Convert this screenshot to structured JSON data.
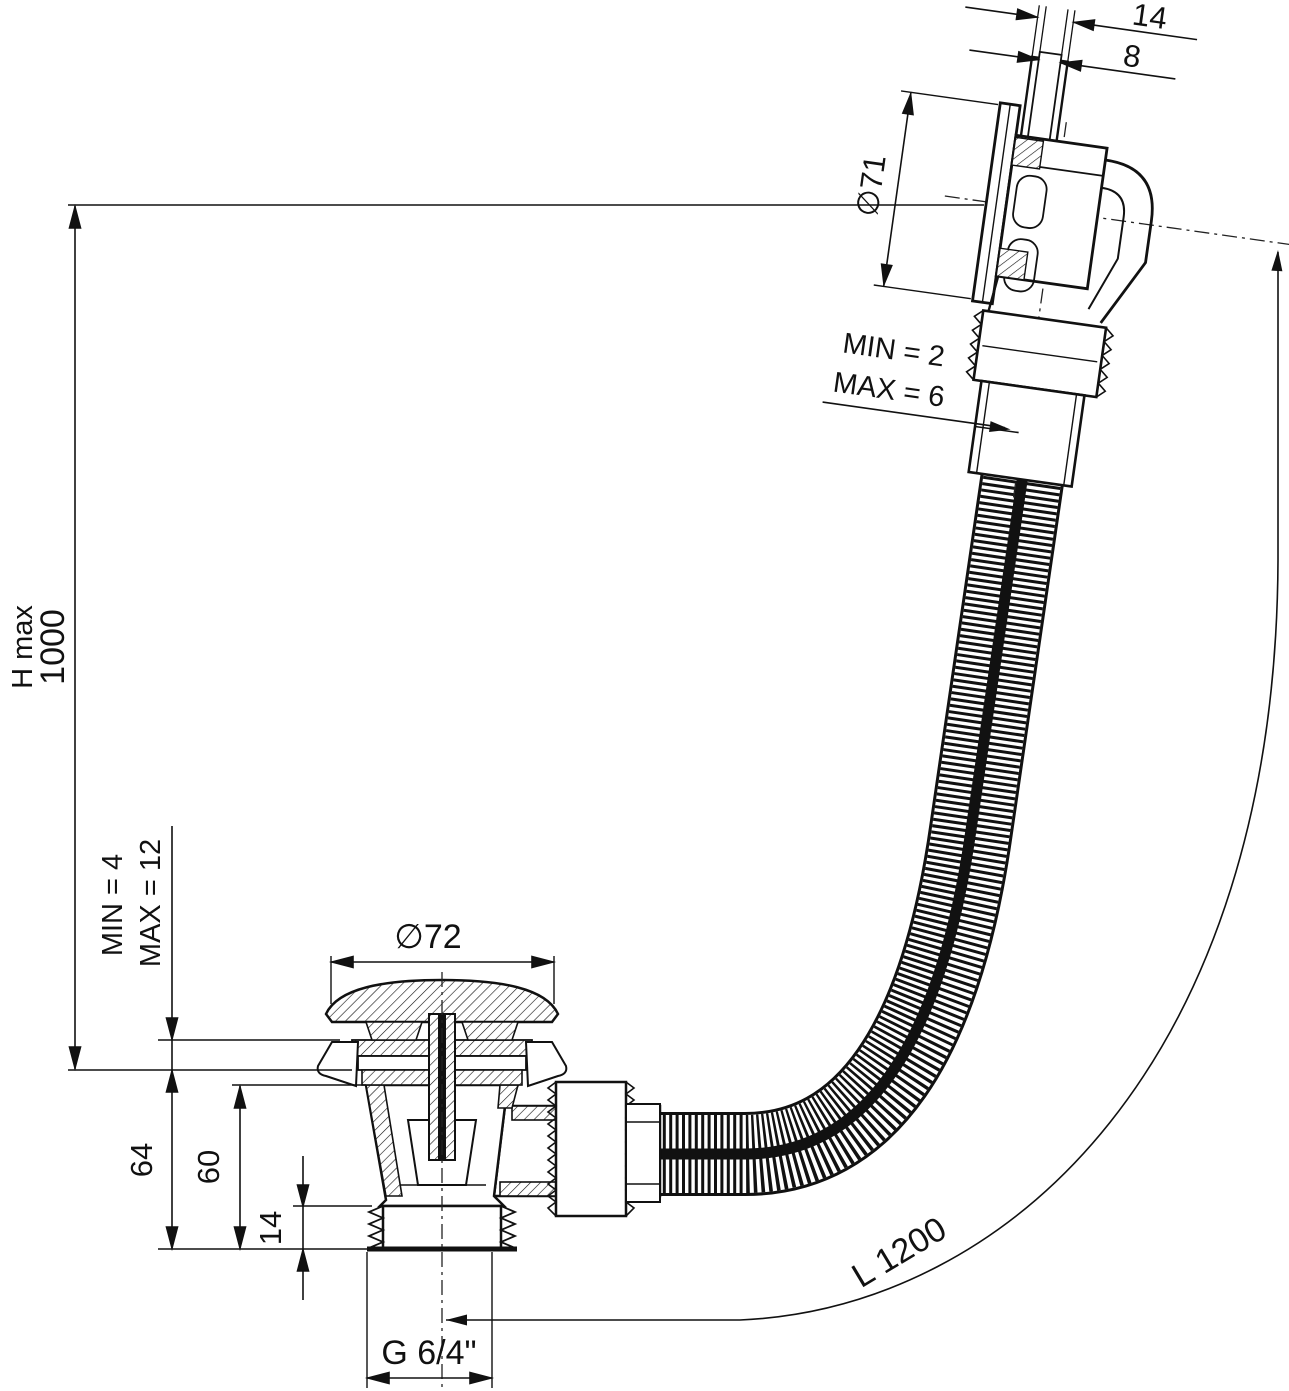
{
  "drawing": {
    "type": "technical-dimension-drawing",
    "subject": "Bath waste and overflow set with flexible hose - sectional drawing",
    "background": "#ffffff",
    "line_color": "#111111",
    "dimensions": {
      "overflow_tube_outer": "14",
      "overflow_tube_inner": "8",
      "overflow_face_diameter": "∅71",
      "overflow_clamp_min": "MIN = 2",
      "overflow_clamp_max": "MAX = 6",
      "height_label": "H max",
      "height_value": "1000",
      "waste_clamp_min": "MIN = 4",
      "waste_clamp_max": "MAX = 12",
      "plug_cap_diameter": "∅72",
      "waste_total_height": "64",
      "waste_body_height": "60",
      "waste_thread_length": "14",
      "waste_thread_size": "G 6/4\"",
      "hose_length": "L 1200"
    }
  }
}
